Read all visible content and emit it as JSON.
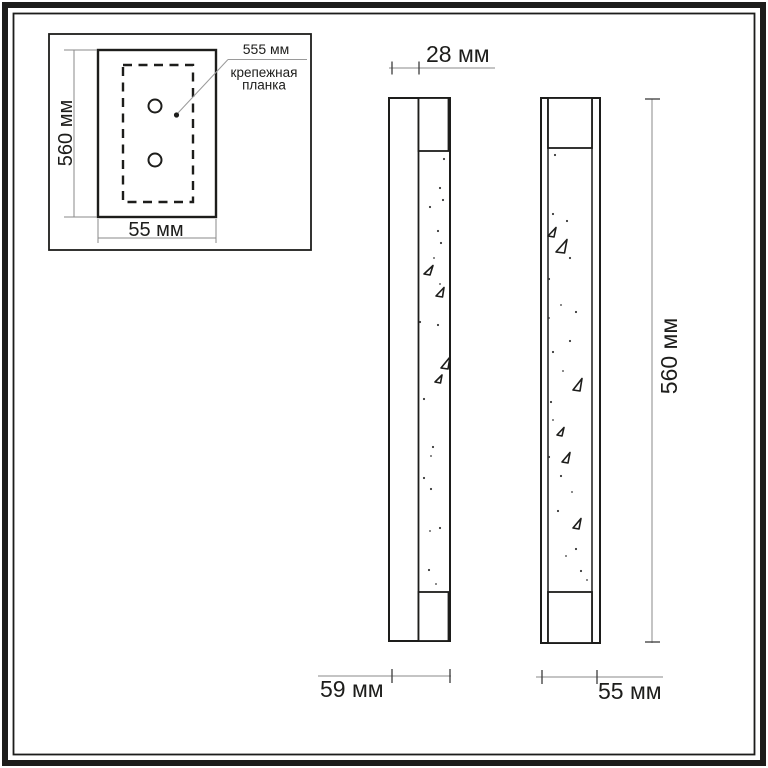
{
  "colors": {
    "ink": "#1d1d1b",
    "dim": "#8a8a8a",
    "tick": "#3c3c3c",
    "bg": "#ffffff"
  },
  "inset": {
    "height": "560 мм",
    "width": "55 мм",
    "callout": {
      "value": "555 мм",
      "name_line1": "крепежная",
      "name_line2": "планка"
    }
  },
  "side_view": {
    "depth_top": "28 мм",
    "depth_bottom": "59 мм"
  },
  "front_view": {
    "height": "560 мм",
    "width": "55 мм"
  }
}
